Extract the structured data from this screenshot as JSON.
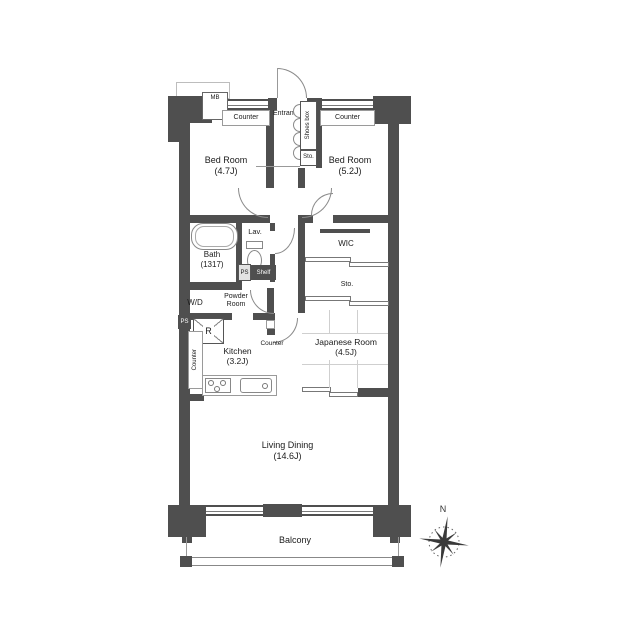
{
  "colors": {
    "wall": "#4f4f4f",
    "thin_line": "#8a8a8a",
    "text": "#1b1b1b",
    "tatami_line": "#cfcfcf",
    "background": "#ffffff"
  },
  "plan": {
    "entry": {
      "mb": "MB",
      "counter_left": "Counter",
      "entrance": "Entrance",
      "shoes_box": "Shoes box",
      "storage": "Sto.",
      "counter_right": "Counter"
    },
    "bedroom1": {
      "name": "Bed Room",
      "size": "(4.7J)"
    },
    "bedroom2": {
      "name": "Bed Room",
      "size": "(5.2J)"
    },
    "sanitary": {
      "bath_name": "Bath",
      "bath_size": "(1317)",
      "lavatory": "Lav.",
      "powder_line1": "Powder",
      "powder_line2": "Room",
      "washer_dryer": "W/D",
      "pipe_space_upper": "PS",
      "pipe_space_lower": "PS",
      "shelf": "Shelf"
    },
    "kitchen": {
      "name": "Kitchen",
      "size": "(3.2J)",
      "counter": "Counter",
      "side_counter": "Counter",
      "refrigerator": "R"
    },
    "wic": {
      "name": "WIC"
    },
    "storage_right": {
      "name": "Sto."
    },
    "japanese_room": {
      "name": "Japanese Room",
      "size": "(4.5J)"
    },
    "living_dining": {
      "name": "Living Dining",
      "size": "(14.6J)"
    },
    "balcony": {
      "name": "Balcony"
    },
    "compass": {
      "north": "N"
    }
  }
}
